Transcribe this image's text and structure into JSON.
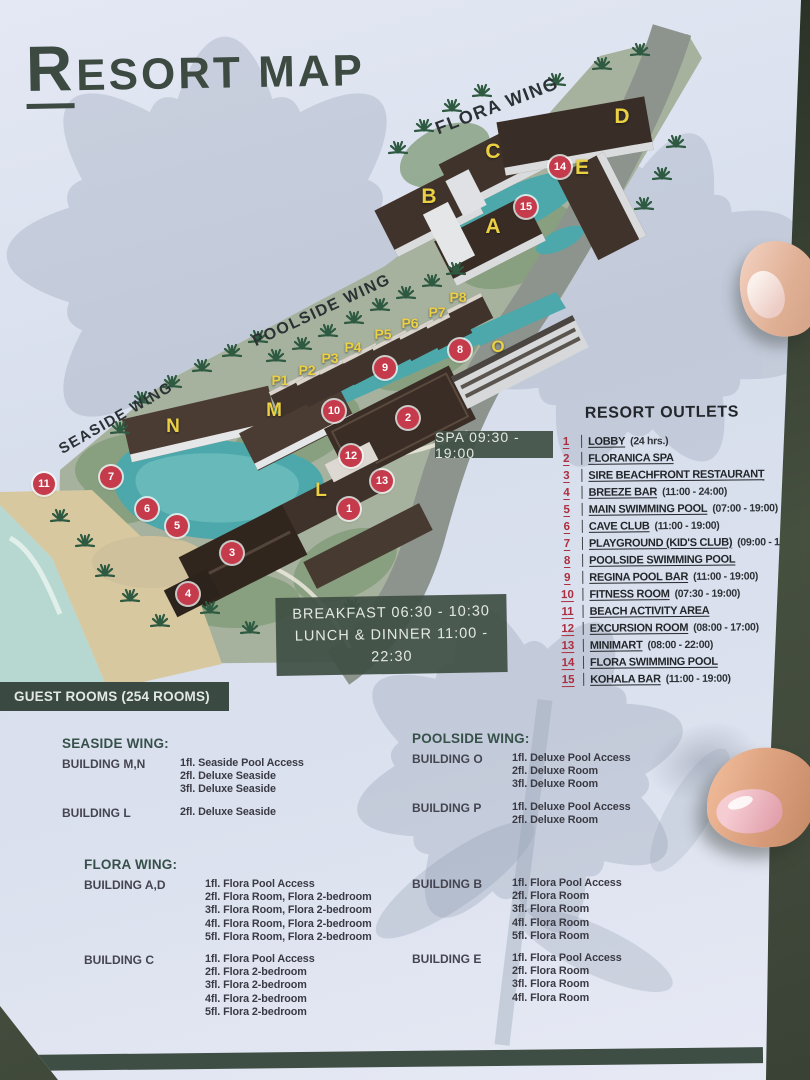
{
  "page": {
    "title": {
      "first": "R",
      "rest": "ESORT MAP"
    }
  },
  "map": {
    "spa_note": "SPA 09:30 - 19:00",
    "meal_line1": "BREAKFAST 06:30 - 10:30",
    "meal_line2": "LUNCH & DINNER 11:00 - 22:30",
    "wing_labels": [
      {
        "text": "FLORA WING",
        "x": 497,
        "y": 106,
        "rot": -21,
        "size": 18
      },
      {
        "text": "POOLSIDE WING",
        "x": 322,
        "y": 311,
        "rot": -25,
        "size": 16
      },
      {
        "text": "SEASIDE WING",
        "x": 116,
        "y": 418,
        "rot": -30,
        "size": 15
      }
    ],
    "building_labels": [
      {
        "text": "A",
        "x": 493,
        "y": 227,
        "size": 21
      },
      {
        "text": "B",
        "x": 429,
        "y": 197,
        "size": 21
      },
      {
        "text": "C",
        "x": 493,
        "y": 152,
        "size": 21
      },
      {
        "text": "D",
        "x": 622,
        "y": 117,
        "size": 21
      },
      {
        "text": "E",
        "x": 582,
        "y": 168,
        "size": 21
      },
      {
        "text": "L",
        "x": 321,
        "y": 491,
        "size": 19
      },
      {
        "text": "M",
        "x": 274,
        "y": 411,
        "size": 19
      },
      {
        "text": "N",
        "x": 173,
        "y": 427,
        "size": 19
      },
      {
        "text": "O",
        "x": 498,
        "y": 347,
        "size": 17
      },
      {
        "text": "P1",
        "x": 280,
        "y": 380,
        "size": 14
      },
      {
        "text": "P2",
        "x": 307,
        "y": 370,
        "size": 14
      },
      {
        "text": "P3",
        "x": 330,
        "y": 358,
        "size": 14
      },
      {
        "text": "P4",
        "x": 353,
        "y": 347,
        "size": 14
      },
      {
        "text": "P5",
        "x": 383,
        "y": 334,
        "size": 14
      },
      {
        "text": "P6",
        "x": 410,
        "y": 323,
        "size": 14
      },
      {
        "text": "P7",
        "x": 437,
        "y": 312,
        "size": 14
      },
      {
        "text": "P8",
        "x": 458,
        "y": 297,
        "size": 14
      }
    ],
    "markers": [
      {
        "num": "1",
        "x": 349,
        "y": 509
      },
      {
        "num": "2",
        "x": 408,
        "y": 418
      },
      {
        "num": "3",
        "x": 232,
        "y": 553
      },
      {
        "num": "4",
        "x": 188,
        "y": 594
      },
      {
        "num": "5",
        "x": 177,
        "y": 526
      },
      {
        "num": "6",
        "x": 147,
        "y": 509
      },
      {
        "num": "7",
        "x": 111,
        "y": 477
      },
      {
        "num": "8",
        "x": 460,
        "y": 350
      },
      {
        "num": "9",
        "x": 385,
        "y": 368
      },
      {
        "num": "10",
        "x": 334,
        "y": 411
      },
      {
        "num": "11",
        "x": 44,
        "y": 484
      },
      {
        "num": "12",
        "x": 351,
        "y": 456
      },
      {
        "num": "13",
        "x": 382,
        "y": 481
      },
      {
        "num": "14",
        "x": 560,
        "y": 167
      },
      {
        "num": "15",
        "x": 526,
        "y": 207
      }
    ]
  },
  "outlets": {
    "title": "RESORT OUTLETS",
    "items": [
      {
        "num": "1",
        "name": "LOBBY",
        "hours": "(24 hrs.)"
      },
      {
        "num": "2",
        "name": "FLORANICA SPA",
        "hours": ""
      },
      {
        "num": "3",
        "name": "SIRE BEACHFRONT RESTAURANT",
        "hours": ""
      },
      {
        "num": "4",
        "name": "BREEZE BAR",
        "hours": "(11:00 - 24:00)"
      },
      {
        "num": "5",
        "name": "MAIN SWIMMING POOL",
        "hours": "(07:00 - 19:00)"
      },
      {
        "num": "6",
        "name": "CAVE CLUB",
        "hours": "(11:00 - 19:00)"
      },
      {
        "num": "7",
        "name": "PLAYGROUND (KID'S CLUB)",
        "hours": "(09:00 - 17:00)"
      },
      {
        "num": "8",
        "name": "POOLSIDE SWIMMING POOL",
        "hours": ""
      },
      {
        "num": "9",
        "name": "REGINA POOL BAR",
        "hours": "(11:00 - 19:00)"
      },
      {
        "num": "10",
        "name": "FITNESS ROOM",
        "hours": "(07:30 - 19:00)"
      },
      {
        "num": "11",
        "name": "BEACH ACTIVITY AREA",
        "hours": ""
      },
      {
        "num": "12",
        "name": "EXCURSION ROOM",
        "hours": "(08:00 - 17:00)"
      },
      {
        "num": "13",
        "name": "MINIMART",
        "hours": "(08:00 - 22:00)"
      },
      {
        "num": "14",
        "name": "FLORA SWIMMING POOL",
        "hours": ""
      },
      {
        "num": "15",
        "name": "KOHALA BAR",
        "hours": "(11:00 - 19:00)"
      }
    ]
  },
  "guest_rooms": {
    "header": "GUEST ROOMS (254 ROOMS)",
    "groups": [
      {
        "key": "seaside",
        "header": "SEASIDE WING:",
        "buildings": [
          {
            "name": "BUILDING M,N",
            "floors": [
              "1fl. Seaside Pool Access",
              "2fl. Deluxe Seaside",
              "3fl. Deluxe Seaside"
            ]
          },
          {
            "name": "BUILDING L",
            "floors": [
              "2fl. Deluxe Seaside"
            ]
          }
        ]
      },
      {
        "key": "poolside",
        "header": "POOLSIDE WING:",
        "buildings": [
          {
            "name": "BUILDING O",
            "floors": [
              "1fl. Deluxe Pool Access",
              "2fl. Deluxe Room",
              "3fl. Deluxe Room"
            ]
          },
          {
            "name": "BUILDING P",
            "floors": [
              "1fl. Deluxe Pool Access",
              "2fl. Deluxe Room"
            ]
          }
        ]
      },
      {
        "key": "flora",
        "header": "FLORA WING:",
        "buildings": [
          {
            "name": "BUILDING A,D",
            "floors": [
              "1fl. Flora Pool Access",
              "2fl. Flora Room, Flora 2-bedroom",
              "3fl. Flora Room, Flora 2-bedroom",
              "4fl. Flora Room, Flora 2-bedroom",
              "5fl. Flora Room, Flora 2-bedroom"
            ]
          },
          {
            "name": "BUILDING C",
            "floors": [
              "1fl. Flora Pool Access",
              "2fl. Flora 2-bedroom",
              "3fl. Flora 2-bedroom",
              "4fl. Flora 2-bedroom",
              "5fl. Flora 2-bedroom"
            ]
          }
        ]
      },
      {
        "key": "flora-be",
        "header": "",
        "buildings": [
          {
            "name": "BUILDING B",
            "floors": [
              "1fl. Flora Pool Access",
              "2fl. Flora Room",
              "3fl. Flora Room",
              "4fl. Flora Room",
              "5fl. Flora Room"
            ]
          },
          {
            "name": "BUILDING E",
            "floors": [
              "1fl. Flora Pool Access",
              "2fl. Flora Room",
              "3fl. Flora Room",
              "4fl. Flora Room"
            ]
          }
        ]
      }
    ]
  },
  "colors": {
    "accent_green": "#3e4e44",
    "marker_red": "#c53b4b",
    "letter_yellow": "#ecd043",
    "paper": "#dce2ef",
    "pool_teal": "#4da8ab"
  }
}
